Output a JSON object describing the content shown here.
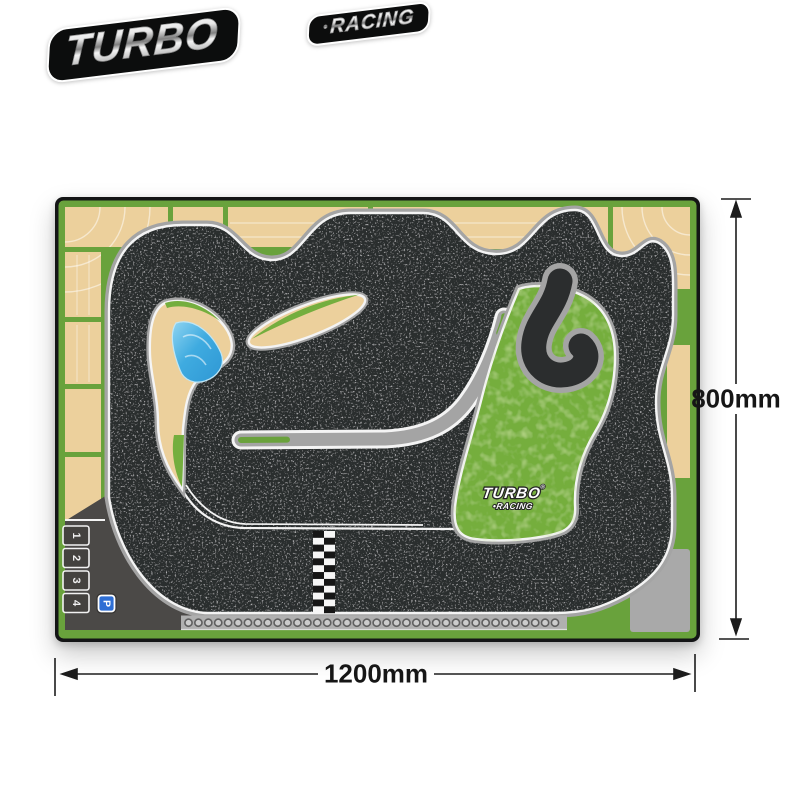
{
  "brand_logo": {
    "line1": "TURBO",
    "separator": "•",
    "line2": "RACING"
  },
  "dimensions": {
    "height_label": "800mm",
    "width_label": "1200mm"
  },
  "mat": {
    "surface_logo": {
      "line1": "TURBO",
      "separator": "•",
      "line2": "RACING",
      "registered_mark": "®"
    },
    "pit": {
      "grid_numbers": [
        "1",
        "2",
        "3",
        "4"
      ],
      "parking_label": "P"
    },
    "finish_line": {
      "columns": 2,
      "rows": 12,
      "color_dark": "#161616",
      "color_light": "#f6f6f6"
    },
    "tire_barrier": {
      "count": 38,
      "ring_color": "#5f5f5f",
      "fill_color": "#cccccc"
    },
    "colors": {
      "asphalt": "#2b2d2e",
      "curb": "#a4a4a4",
      "edge_line": "#f4f4f4",
      "grass": "#6aa23c",
      "infield_grass": "#74ae3e",
      "sand": "#ecd09c",
      "pool_blue": "#3fabe0",
      "pit_floor": "#4b4947",
      "runoff_gray": "#a9a9a9",
      "frame": "#141516",
      "parking_blue": "#2e6ed4"
    }
  }
}
